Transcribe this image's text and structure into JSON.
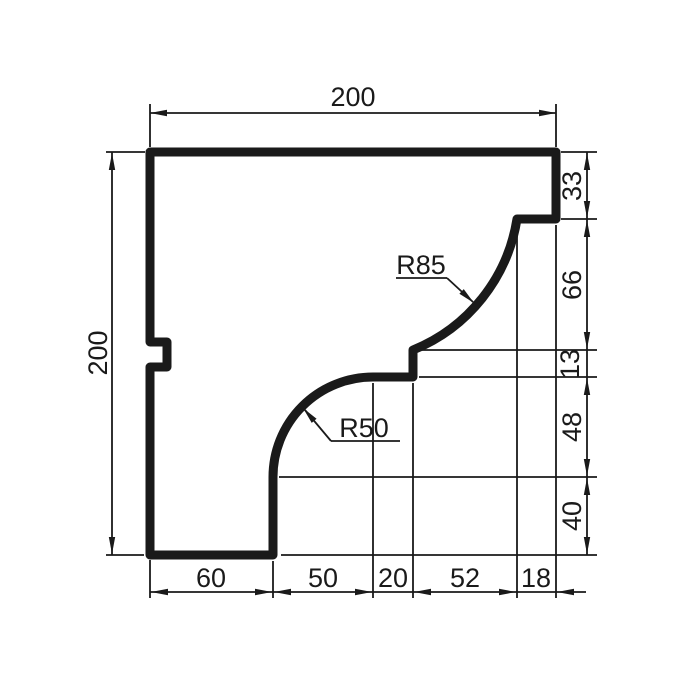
{
  "drawing": {
    "type": "technical-profile-drawing",
    "description": "Cross-section profile of a cornice molding with chained dimensions",
    "dims": {
      "top": "200",
      "left": "200",
      "right": [
        "33",
        "66",
        "13",
        "48",
        "40"
      ],
      "bottom": [
        "60",
        "50",
        "20",
        "52",
        "18"
      ]
    },
    "radius_labels": [
      "R85",
      "R50"
    ],
    "colors": {
      "line": "#1a1a1a",
      "background": "#ffffff"
    }
  }
}
